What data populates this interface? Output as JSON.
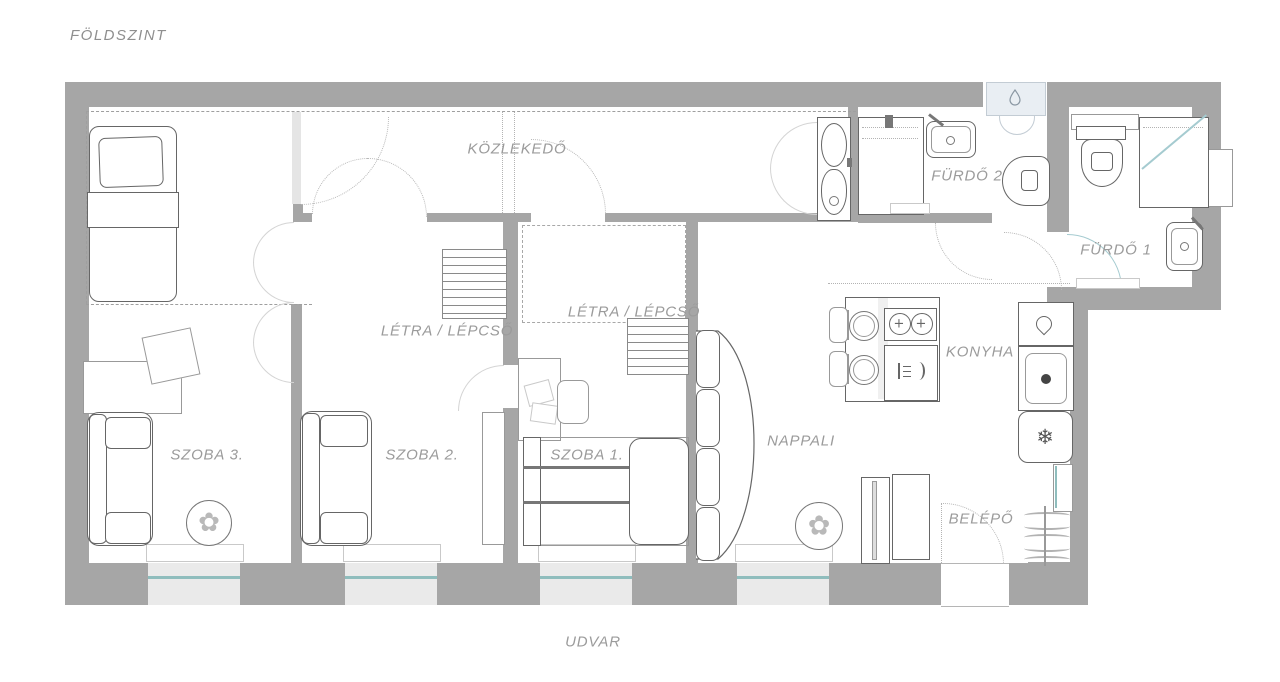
{
  "title": "FÖLDSZINT",
  "outside": {
    "label": "UDVAR"
  },
  "rooms": {
    "kozlekedo": {
      "label": "KÖZLEKEDŐ"
    },
    "stairs_szoba2": {
      "label": "LÉTRA / LÉPCSŐ"
    },
    "stairs_szoba1": {
      "label": "LÉTRA / LÉPCSŐ"
    },
    "furdo2": {
      "label": "FÜRDŐ 2"
    },
    "furdo1": {
      "label": "FÜRDŐ 1"
    },
    "konyha": {
      "label": "KONYHA"
    },
    "szoba3": {
      "label": "SZOBA 3."
    },
    "szoba2": {
      "label": "SZOBA 2."
    },
    "szoba1": {
      "label": "SZOBA 1."
    },
    "nappali": {
      "label": "NAPPALI"
    },
    "belepo": {
      "label": "BELÉPŐ"
    }
  },
  "icons": {
    "fridge": "❄",
    "plant": "✿",
    "burner": "+"
  },
  "colors": {
    "wall": "#a6a6a6",
    "window_glass": "#8fbdbd",
    "label_text": "#9b9b9b",
    "boiler_fill": "#e9eef3"
  }
}
